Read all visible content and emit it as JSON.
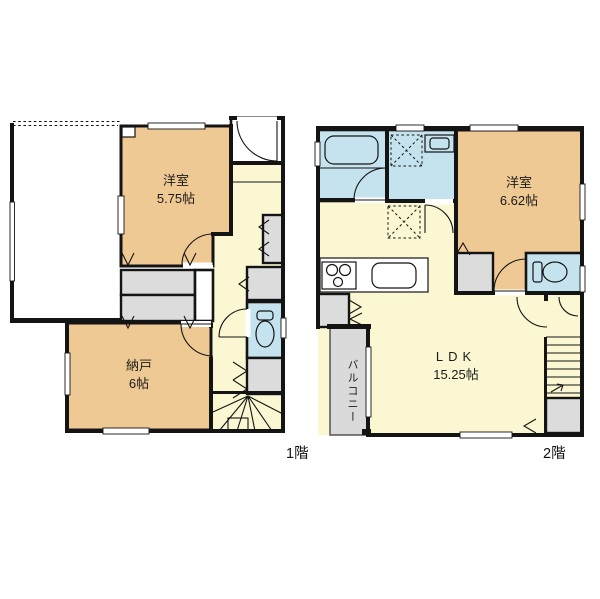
{
  "title": "2-story house floor plan",
  "colors": {
    "room_tan": "#EFC993",
    "hall_yellow": "#FAF7D2",
    "wet_blue": "#C5E3EE",
    "closet_gray": "#DCDCDC",
    "balcony_gray": "#DADADA",
    "wall_black": "#141414"
  },
  "floor1": {
    "label": "1階",
    "rooms": {
      "yoshitsu": {
        "name": "洋室",
        "size": "5.75帖"
      },
      "nando": {
        "name": "納戸",
        "size": "6帖"
      }
    }
  },
  "floor2": {
    "label": "2階",
    "rooms": {
      "yoshitsu": {
        "name": "洋室",
        "size": "6.62帖"
      },
      "ldk": {
        "name": "LDK",
        "size": "15.25帖"
      },
      "balcony": {
        "name": "バルコニー"
      }
    }
  }
}
